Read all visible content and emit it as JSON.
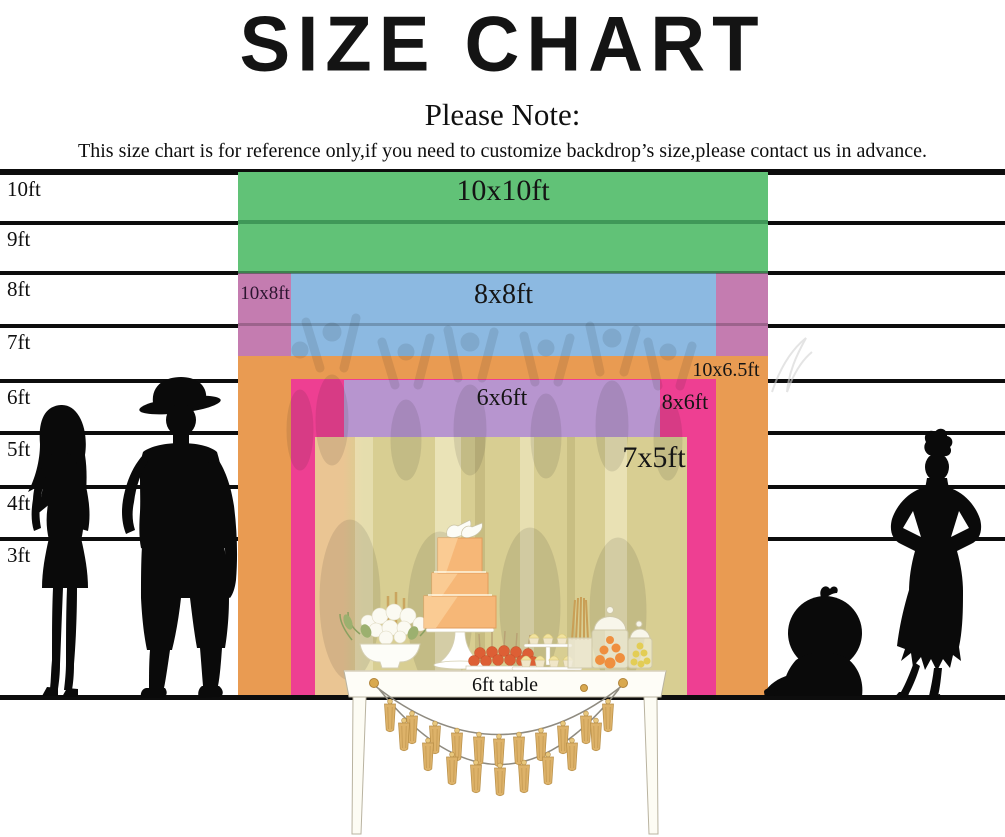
{
  "title": "SIZE CHART",
  "note": {
    "heading": "Please Note:",
    "body": "This size chart is for reference only,if you need to customize backdrop’s size,please contact us in advance."
  },
  "axis": {
    "unit": "ft",
    "ticks": [
      "10ft",
      "9ft",
      "8ft",
      "7ft",
      "6ft",
      "5ft",
      "4ft",
      "3ft"
    ],
    "line_color": "#0d0d0d"
  },
  "sizes": [
    {
      "label": "10x10ft",
      "width_ft": 10,
      "height_ft": 10,
      "color": "#61c277"
    },
    {
      "label": "10x8ft",
      "width_ft": 10,
      "height_ft": 8,
      "color": "#c47cb0"
    },
    {
      "label": "8x8ft",
      "width_ft": 8,
      "height_ft": 8,
      "color": "#8cb9e1"
    },
    {
      "label": "10x6.5ft",
      "width_ft": 10,
      "height_ft": 6.5,
      "color": "#e99b52"
    },
    {
      "label": "8x6ft",
      "width_ft": 8,
      "height_ft": 6,
      "color": "#ee3f92"
    },
    {
      "label": "6x6ft",
      "width_ft": 6,
      "height_ft": 6,
      "color": "#b795cf"
    },
    {
      "label": "7x5ft",
      "width_ft": 7,
      "height_ft": 5,
      "color": "#d8ce92"
    }
  ],
  "table": {
    "label": "6ft table"
  }
}
